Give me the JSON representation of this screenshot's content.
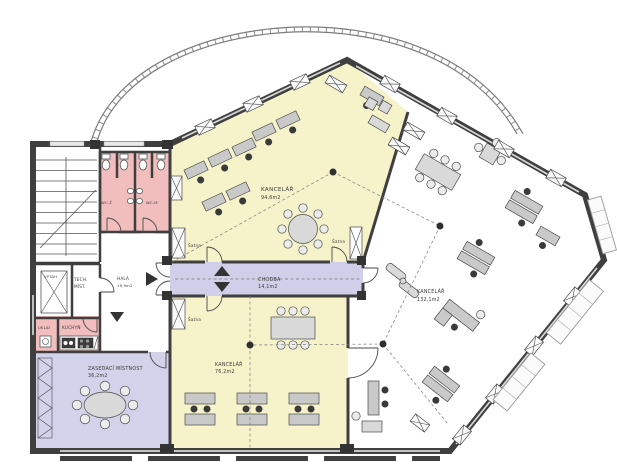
{
  "plan": {
    "rooms": {
      "kancelar_top": {
        "name": "KANCELÁŘ",
        "area": "94,6m2"
      },
      "kancelar_bottom": {
        "name": "KANCELÁŘ",
        "area": "76,2m2"
      },
      "kancelar_right": {
        "name": "KANCELÁŘ",
        "area": "132,1m2"
      },
      "chodba": {
        "name": "CHODBA",
        "area": "14,1m2"
      },
      "zasedaci": {
        "name": "ZASEDACÍ MÍSTNOST",
        "area": "36,2m2"
      },
      "hala": {
        "name": "HALA",
        "area": "19,9m2"
      },
      "tech_mist": {
        "line1": "TECH.",
        "line2": "MÍST."
      },
      "vytah": {
        "name": "VÝTAH"
      },
      "uklid": {
        "name": "ÚKLID"
      },
      "kuchyn": {
        "name": "KUCHYŇ"
      },
      "wc_z": {
        "name": "WC-Ž"
      },
      "wc_m": {
        "name": "WC-M"
      },
      "satna": {
        "name": "Šatna"
      }
    },
    "colors": {
      "office_fill": "#f6f3cb",
      "corridor_fill": "#cfcfe9",
      "meeting_fill": "#d2d2ea",
      "sanitary_fill": "#f2bdbd",
      "wall": "#3f3f3f"
    }
  }
}
